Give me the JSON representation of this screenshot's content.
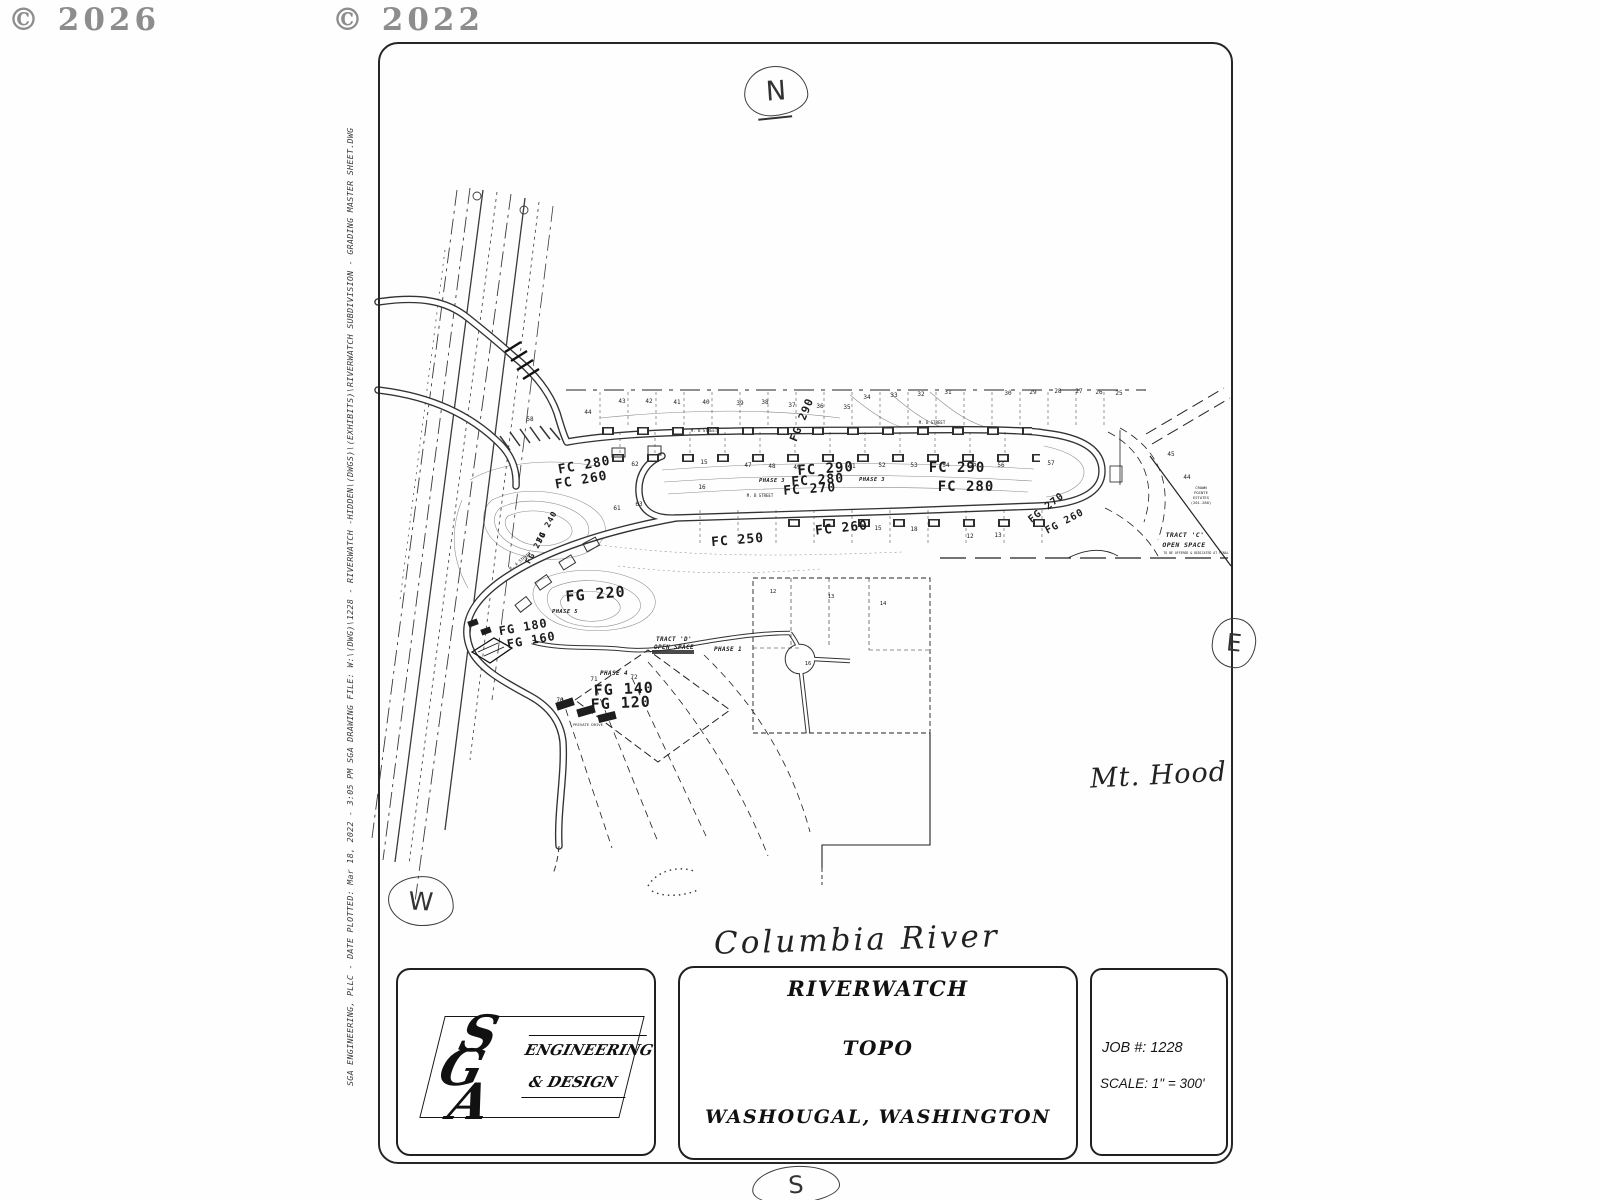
{
  "watermarks": {
    "left": "© 2026",
    "center": "© 2022"
  },
  "compass": {
    "north": "N",
    "east": "E",
    "south": "S",
    "west": "W"
  },
  "plot_stamp": "SGA ENGINEERING, PLLC  -  DATE PLOTTED:  Mar 18, 2022  -  3:05 PM        SGA DRAWING FILE:  W:\\(DWG)\\1228  -  RIVERWATCH -HIDDEN\\(DWGS)\\(EXHIBITS)\\RIVERWATCH SUBDIVISION  -  GRADING MASTER SHEET.DWG",
  "annotations": {
    "river": "Columbia River",
    "mountain": "Mt. Hood"
  },
  "title_block": {
    "firm": {
      "s": "S",
      "g": "G",
      "a": "A",
      "line1": "ENGINEERING",
      "line2": "& DESIGN"
    },
    "project": {
      "line1": "RIVERWATCH",
      "line2": "TOPO",
      "line3": "WASHOUGAL,  WASHINGTON"
    },
    "job": {
      "number": "JOB  #: 1228",
      "scale": "SCALE: 1\" =  300'"
    }
  },
  "map": {
    "labels": [
      {
        "t": "FC 280",
        "x": 585,
        "y": 469,
        "s": 13,
        "r": -10,
        "c": "el"
      },
      {
        "t": "FC 260",
        "x": 582,
        "y": 484,
        "s": 13,
        "r": -10,
        "c": "el"
      },
      {
        "t": "FG 290",
        "x": 805,
        "y": 421,
        "s": 11,
        "r": -68,
        "c": "el"
      },
      {
        "t": "FC 290",
        "x": 826,
        "y": 473,
        "s": 14,
        "r": -4,
        "c": "el"
      },
      {
        "t": "FC 280",
        "x": 818,
        "y": 484,
        "s": 13,
        "r": -4,
        "c": "el"
      },
      {
        "t": "FC 270",
        "x": 810,
        "y": 493,
        "s": 13,
        "r": -4,
        "c": "el"
      },
      {
        "t": "FC 290",
        "x": 957,
        "y": 472,
        "s": 14,
        "r": 0,
        "c": "el"
      },
      {
        "t": "FC 280",
        "x": 966,
        "y": 491,
        "s": 14,
        "r": 0,
        "c": "el"
      },
      {
        "t": "FC 260",
        "x": 842,
        "y": 532,
        "s": 13,
        "r": -6,
        "c": "el"
      },
      {
        "t": "FC 250",
        "x": 738,
        "y": 544,
        "s": 13,
        "r": -5,
        "c": "el"
      },
      {
        "t": "FG 270",
        "x": 1048,
        "y": 510,
        "s": 10,
        "r": -38,
        "c": "el"
      },
      {
        "t": "FG 260",
        "x": 1066,
        "y": 524,
        "s": 10,
        "r": -28,
        "c": "el"
      },
      {
        "t": "FG 240",
        "x": 549,
        "y": 528,
        "s": 8,
        "r": -62,
        "c": "el"
      },
      {
        "t": "FG 230",
        "x": 538,
        "y": 549,
        "s": 8,
        "r": -62,
        "c": "el"
      },
      {
        "t": "FG 220",
        "x": 596,
        "y": 599,
        "s": 15,
        "r": -5,
        "c": "el"
      },
      {
        "t": "FG 180",
        "x": 524,
        "y": 631,
        "s": 12,
        "r": -10,
        "c": "el"
      },
      {
        "t": "FG 160",
        "x": 532,
        "y": 644,
        "s": 12,
        "r": -10,
        "c": "el"
      },
      {
        "t": "FG 140",
        "x": 624,
        "y": 694,
        "s": 15,
        "r": -3,
        "c": "el"
      },
      {
        "t": "FG 120",
        "x": 621,
        "y": 708,
        "s": 15,
        "r": -3,
        "c": "el"
      },
      {
        "t": "PHASE 3",
        "x": 772,
        "y": 482,
        "s": 5.5,
        "r": 0,
        "c": "ph"
      },
      {
        "t": "PHASE 3",
        "x": 872,
        "y": 481,
        "s": 5.5,
        "r": 0,
        "c": "ph"
      },
      {
        "t": "PHASE 5",
        "x": 565,
        "y": 613,
        "s": 5.5,
        "r": 0,
        "c": "ph"
      },
      {
        "t": "PHASE 1",
        "x": 728,
        "y": 651,
        "s": 6,
        "r": 0,
        "c": "ph"
      },
      {
        "t": "PHASE 4",
        "x": 614,
        "y": 675,
        "s": 6,
        "r": 0,
        "c": "ph"
      },
      {
        "t": "TRACT 'C'",
        "x": 1185,
        "y": 537,
        "s": 6.5,
        "r": 0,
        "c": "ph"
      },
      {
        "t": "OPEN SPACE",
        "x": 1184,
        "y": 547,
        "s": 6.5,
        "r": 0,
        "c": "ph"
      },
      {
        "t": "TRACT 'D'",
        "x": 674,
        "y": 641,
        "s": 6,
        "r": 0,
        "c": "ph"
      },
      {
        "t": "OPEN SPACE",
        "x": 674,
        "y": 649,
        "s": 6,
        "r": 0,
        "c": "ph"
      },
      {
        "t": "CROWN",
        "x": 1201,
        "y": 489,
        "s": 3.8,
        "r": 0
      },
      {
        "t": "POINTE",
        "x": 1201,
        "y": 494,
        "s": 3.8,
        "r": 0
      },
      {
        "t": "ESTATES",
        "x": 1201,
        "y": 499,
        "s": 3.8,
        "r": 0
      },
      {
        "t": "(201-280)",
        "x": 1201,
        "y": 504,
        "s": 3.8,
        "r": 0
      },
      {
        "t": "TO BE OFFERED & DEDICATED AT FINAL",
        "x": 1196,
        "y": 554,
        "s": 3.2,
        "r": 0
      },
      {
        "t": "M. B STREET",
        "x": 932,
        "y": 424,
        "s": 4,
        "r": 0
      },
      {
        "t": "M. B STREET",
        "x": 760,
        "y": 497,
        "s": 4,
        "r": 0
      },
      {
        "t": "M. B STREET",
        "x": 704,
        "y": 432,
        "s": 4,
        "r": 0
      },
      {
        "t": "M. A STREET",
        "x": 521,
        "y": 562,
        "s": 4,
        "r": -38
      },
      {
        "t": "PRIVATE DRIVE",
        "x": 588,
        "y": 726,
        "s": 3.8,
        "r": 0
      },
      {
        "t": "44",
        "x": 588,
        "y": 414,
        "s": 6,
        "r": 0
      },
      {
        "t": "43",
        "x": 622,
        "y": 403,
        "s": 6,
        "r": 0
      },
      {
        "t": "42",
        "x": 649,
        "y": 403,
        "s": 6,
        "r": 0
      },
      {
        "t": "41",
        "x": 677,
        "y": 404,
        "s": 6,
        "r": 0
      },
      {
        "t": "40",
        "x": 706,
        "y": 404,
        "s": 6,
        "r": 0
      },
      {
        "t": "39",
        "x": 740,
        "y": 405,
        "s": 6,
        "r": 0
      },
      {
        "t": "38",
        "x": 765,
        "y": 404,
        "s": 6,
        "r": 0
      },
      {
        "t": "37",
        "x": 792,
        "y": 407,
        "s": 6,
        "r": 0
      },
      {
        "t": "36",
        "x": 820,
        "y": 408,
        "s": 6,
        "r": 0
      },
      {
        "t": "35",
        "x": 847,
        "y": 409,
        "s": 6,
        "r": 0
      },
      {
        "t": "34",
        "x": 867,
        "y": 399,
        "s": 6,
        "r": 0
      },
      {
        "t": "33",
        "x": 894,
        "y": 397,
        "s": 6,
        "r": 0
      },
      {
        "t": "32",
        "x": 921,
        "y": 396,
        "s": 6,
        "r": 0
      },
      {
        "t": "31",
        "x": 948,
        "y": 394,
        "s": 6,
        "r": 0
      },
      {
        "t": "30",
        "x": 1008,
        "y": 395,
        "s": 6,
        "r": 0
      },
      {
        "t": "29",
        "x": 1033,
        "y": 394,
        "s": 6,
        "r": 0
      },
      {
        "t": "28",
        "x": 1058,
        "y": 393,
        "s": 6,
        "r": 0
      },
      {
        "t": "27",
        "x": 1079,
        "y": 393,
        "s": 6,
        "r": 0
      },
      {
        "t": "26",
        "x": 1099,
        "y": 394,
        "s": 6,
        "r": 0
      },
      {
        "t": "25",
        "x": 1119,
        "y": 395,
        "s": 6,
        "r": 0
      },
      {
        "t": "47",
        "x": 748,
        "y": 467,
        "s": 6,
        "r": 0
      },
      {
        "t": "48",
        "x": 772,
        "y": 468,
        "s": 6,
        "r": 0
      },
      {
        "t": "49",
        "x": 797,
        "y": 469,
        "s": 6,
        "r": 0
      },
      {
        "t": "51",
        "x": 852,
        "y": 468,
        "s": 6,
        "r": 0
      },
      {
        "t": "52",
        "x": 882,
        "y": 467,
        "s": 6,
        "r": 0
      },
      {
        "t": "53",
        "x": 914,
        "y": 467,
        "s": 6,
        "r": 0
      },
      {
        "t": "54",
        "x": 946,
        "y": 467,
        "s": 6,
        "r": 0
      },
      {
        "t": "55",
        "x": 973,
        "y": 466,
        "s": 6,
        "r": 0
      },
      {
        "t": "56",
        "x": 1001,
        "y": 467,
        "s": 6,
        "r": 0
      },
      {
        "t": "57",
        "x": 1051,
        "y": 465,
        "s": 6,
        "r": 0
      },
      {
        "t": "62",
        "x": 635,
        "y": 466,
        "s": 6,
        "r": 0
      },
      {
        "t": "15",
        "x": 704,
        "y": 464,
        "s": 6,
        "r": 0
      },
      {
        "t": "16",
        "x": 702,
        "y": 489,
        "s": 6,
        "r": 0
      },
      {
        "t": "61",
        "x": 617,
        "y": 510,
        "s": 6,
        "r": 0
      },
      {
        "t": "63",
        "x": 639,
        "y": 506,
        "s": 6,
        "r": 0
      },
      {
        "t": "58",
        "x": 530,
        "y": 421,
        "s": 6,
        "r": 0
      },
      {
        "t": "15",
        "x": 878,
        "y": 530,
        "s": 6,
        "r": 0
      },
      {
        "t": "18",
        "x": 914,
        "y": 531,
        "s": 6,
        "r": 0
      },
      {
        "t": "12",
        "x": 970,
        "y": 538,
        "s": 6,
        "r": 0
      },
      {
        "t": "13",
        "x": 998,
        "y": 537,
        "s": 6,
        "r": 0
      },
      {
        "t": "70",
        "x": 560,
        "y": 702,
        "s": 6,
        "r": 0
      },
      {
        "t": "71",
        "x": 594,
        "y": 681,
        "s": 6,
        "r": 0
      },
      {
        "t": "72",
        "x": 634,
        "y": 679,
        "s": 6,
        "r": 0
      },
      {
        "t": "45",
        "x": 1171,
        "y": 456,
        "s": 6,
        "r": 0
      },
      {
        "t": "44",
        "x": 1187,
        "y": 479,
        "s": 6,
        "r": 0
      },
      {
        "t": "12",
        "x": 773,
        "y": 593,
        "s": 5.5,
        "r": 0
      },
      {
        "t": "13",
        "x": 831,
        "y": 598,
        "s": 5.5,
        "r": 0
      },
      {
        "t": "14",
        "x": 883,
        "y": 605,
        "s": 5.5,
        "r": 0
      },
      {
        "t": "16",
        "x": 808,
        "y": 665,
        "s": 5.5,
        "r": 0
      }
    ]
  }
}
